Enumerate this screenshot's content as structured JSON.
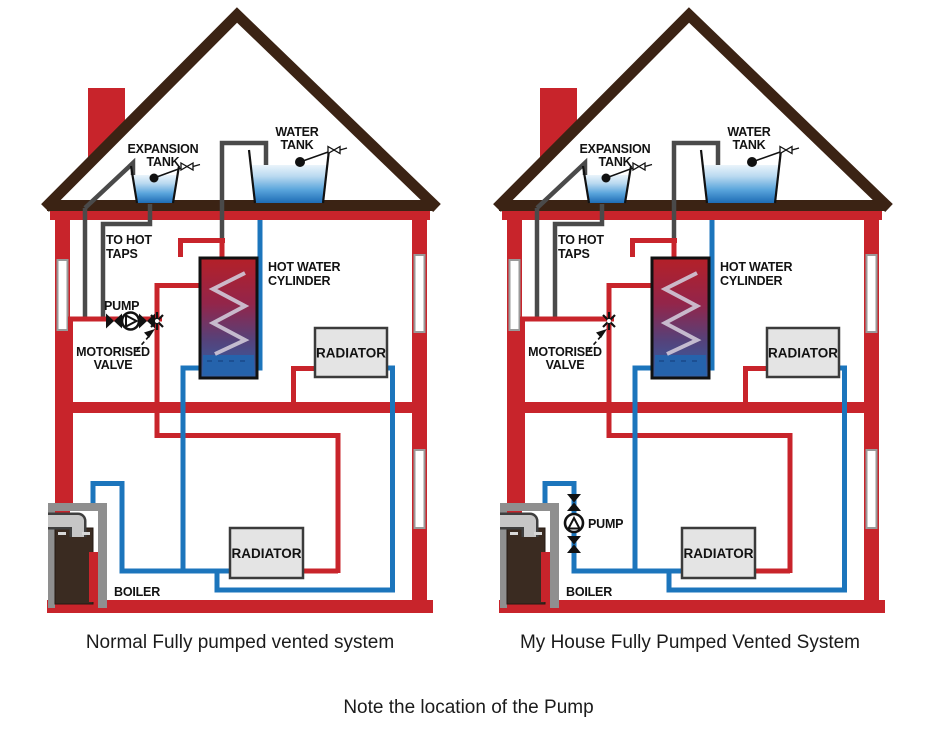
{
  "captions": {
    "left": "Normal Fully pumped vented system",
    "right": "My House Fully Pumped Vented System",
    "note": "Note the location of the Pump"
  },
  "house_left": {
    "labels": {
      "expansion_tank": [
        "EXPANSION",
        "TANK"
      ],
      "water_tank": [
        "WATER",
        "TANK"
      ],
      "to_hot_taps": [
        "TO HOT",
        "TAPS"
      ],
      "pump": "PUMP",
      "motorised_valve": [
        "MOTORISED",
        "VALVE"
      ],
      "hot_water_cylinder": [
        "HOT WATER",
        "CYLINDER"
      ],
      "radiator_upper": "RADIATOR",
      "radiator_lower": "RADIATOR",
      "boiler": "BOILER"
    }
  },
  "house_right": {
    "labels": {
      "expansion_tank": [
        "EXPANSION",
        "TANK"
      ],
      "water_tank": [
        "WATER",
        "TANK"
      ],
      "to_hot_taps": [
        "TO HOT",
        "TAPS"
      ],
      "pump": "PUMP",
      "motorised_valve": [
        "MOTORISED",
        "VALVE"
      ],
      "hot_water_cylinder": [
        "HOT WATER",
        "CYLINDER"
      ],
      "radiator_upper": "RADIATOR",
      "radiator_lower": "RADIATOR",
      "boiler": "BOILER"
    }
  },
  "icons": {
    "pump": "circle-with-triangle",
    "gate_valve": "bowtie",
    "motorised_valve": "star-cross",
    "float_valve": "ball-cock-with-bowtie"
  },
  "colors": {
    "pipe_red": "#c8242b",
    "pipe_blue": "#1c75bc",
    "roof_brown": "#3b2314",
    "vent_gray": "#4a4a4a",
    "radiator_fill": "#e4e4e4",
    "boiler_brown": "#3a2b21",
    "frame_gray": "#8f8f8f"
  }
}
